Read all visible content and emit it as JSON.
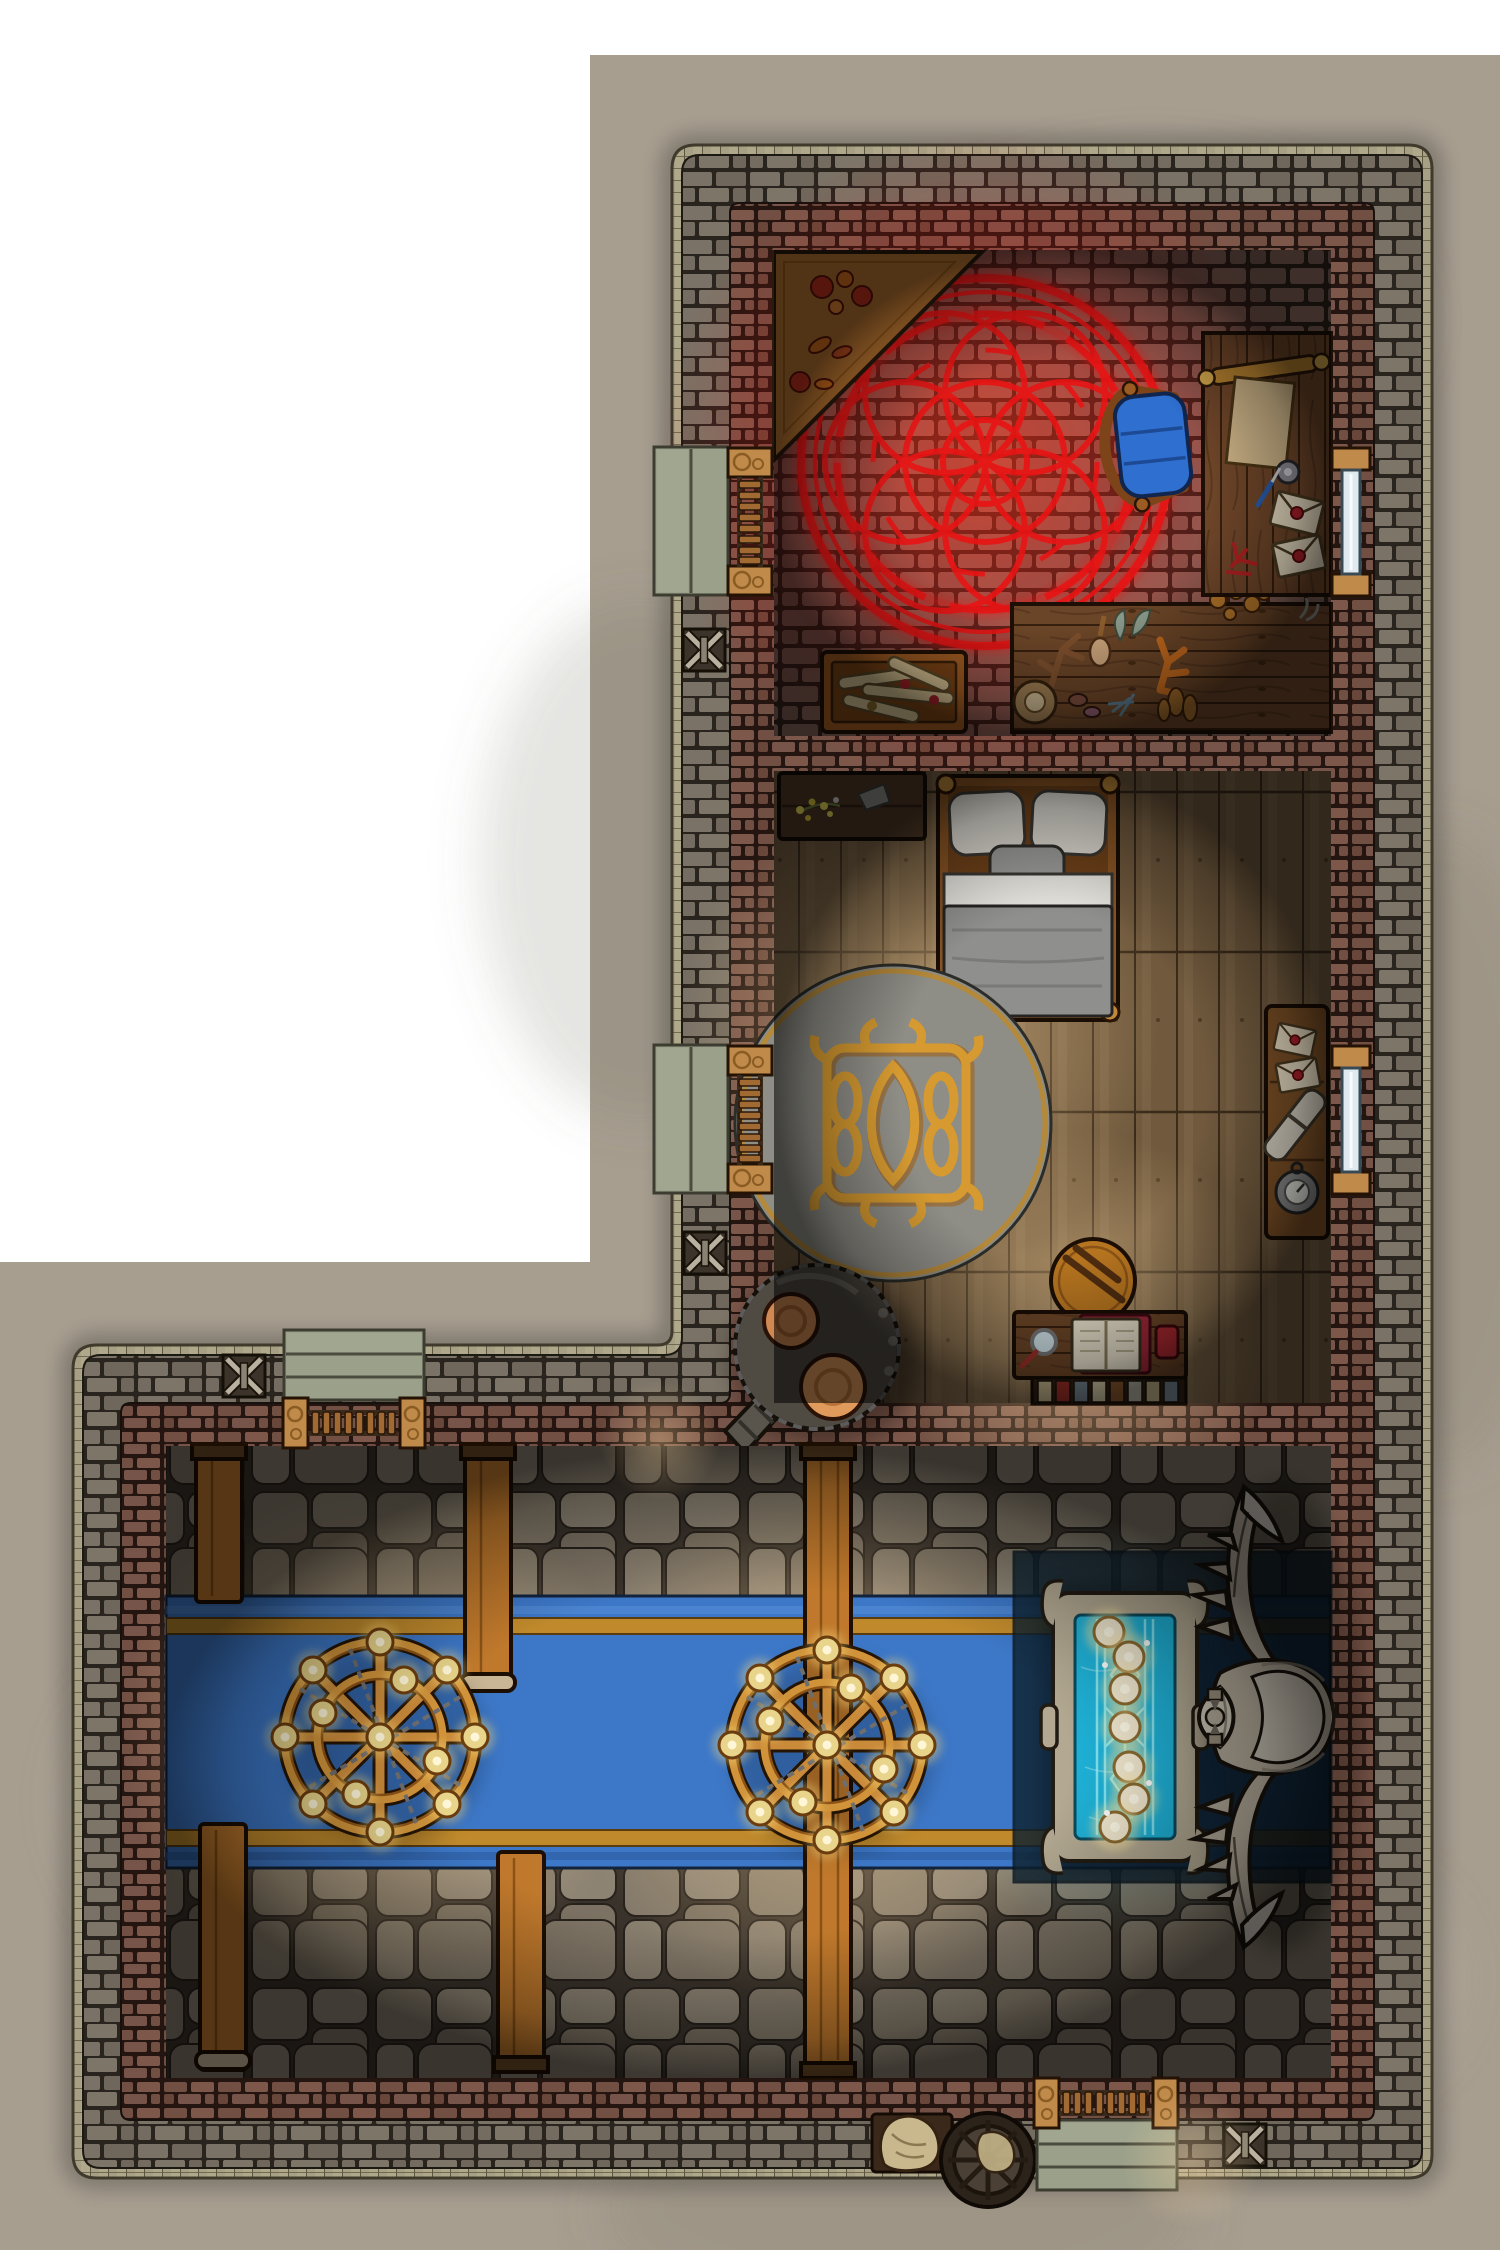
{
  "map": {
    "kind": "top-down fantasy battlemap",
    "scene": "L-shaped stone building: ritual chamber and bedroom in the upper wing, great hall with blue carpet in the lower wing, surrounded by concrete ground"
  },
  "colors": {
    "page_bg": "#ffffff",
    "ground": "#a79e90",
    "trim": "#b0a88b",
    "wall_gray": "#767164",
    "wall_brown": "#714f43",
    "ritual_floor": "#7f6157",
    "ritual_glow": "#e81414",
    "wood_floor": "#70593d",
    "flagstone": "#827868",
    "carpet": "#3d78c8",
    "carpet_stripe": "#c08a2c",
    "runner": "#0e2230",
    "beam_wood": "#c0792c",
    "desk_wood": "#6b4527",
    "crate_wood": "#a25c22",
    "chair_blue": "#2f6fd0",
    "parchment": "#d8c394",
    "envelope": "#e8dcc2",
    "wax_seal": "#a82028",
    "bed_frame": "#8a5524",
    "pillow": "#dedbd2",
    "blanket": "#8f8f8d",
    "sheet": "#e6e4de",
    "rug_base": "#8e8d86",
    "rug_gold": "#d69a30",
    "furnace_metal": "#4f4a42",
    "furnace_glow": "#d08952",
    "table_stone": "#b3a992",
    "table_top": "#1fb2d8",
    "table_pattern": "#8feef8",
    "candle": "#f3ead0",
    "candle_glow": "#ffe9a0",
    "bone": "#b5ac9c",
    "door_wood": "#a06a32",
    "lintel": "#c08a4a",
    "steps": "#9aa089",
    "glass": "#dfe9f0",
    "gold": "#d0933a",
    "chain": "#6e6e6e",
    "sack": "#c9b88e",
    "wheel": "#2c241a"
  },
  "rooms": [
    {
      "id": "ritual-room",
      "label": "Ritual chamber",
      "furniture": [
        "corner-shelf",
        "summoning-circle",
        "writing-desk",
        "blue-armchair",
        "scroll-crate",
        "ingredient-table"
      ]
    },
    {
      "id": "bedroom",
      "label": "Bedroom",
      "furniture": [
        "wall-shelf",
        "double-bed",
        "round-gold-rug",
        "letter-side-table",
        "boiler-furnace",
        "wooden-stool",
        "reading-desk",
        "book-row"
      ]
    },
    {
      "id": "great-hall",
      "label": "Great hall",
      "furniture": [
        "blue-carpet",
        "roof-beams",
        "chandelier-west",
        "chandelier-east",
        "enchanted-blue-table",
        "bone-creature",
        "grain-sack",
        "cart-wheel"
      ]
    }
  ],
  "features": {
    "doors": 4,
    "windows": 2,
    "wall_anchors": 4,
    "chandeliers": 2,
    "candles_per_chandelier": 12,
    "enchanted_table_candles": 6
  }
}
